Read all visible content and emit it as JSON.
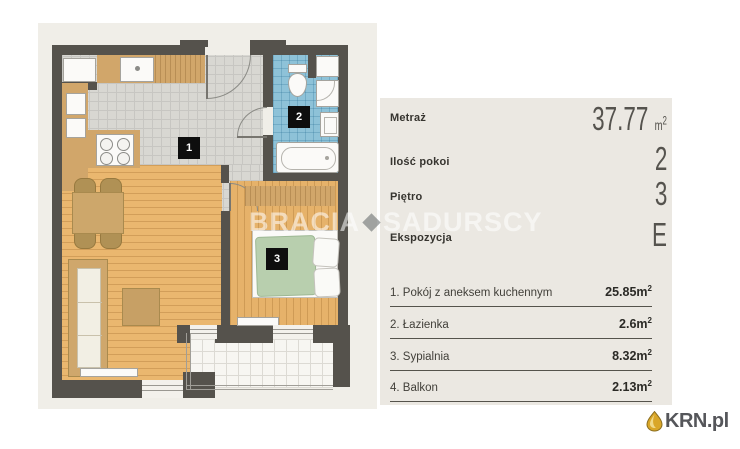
{
  "watermark": {
    "left": "BRACIA",
    "right": "SADURSCY"
  },
  "floor_plan": {
    "labels": {
      "living": "1",
      "bathroom": "2",
      "bedroom": "3"
    }
  },
  "details_panel": {
    "specs": [
      {
        "label": "Metraż",
        "value": "37.77",
        "unit_base": "m",
        "unit_sup": "2"
      },
      {
        "label": "Ilość pokoi",
        "value": "2"
      },
      {
        "label": "Piętro",
        "value": "3"
      },
      {
        "label": "Ekspozycja",
        "value": "E"
      }
    ],
    "rooms": [
      {
        "name": "1. Pokój z aneksem kuchennym",
        "area_base": "25.85m",
        "area_sup": "2"
      },
      {
        "name": "2. Łazienka",
        "area_base": "2.6m",
        "area_sup": "2"
      },
      {
        "name": "3. Sypialnia",
        "area_base": "8.32m",
        "area_sup": "2"
      },
      {
        "name": "4. Balkon",
        "area_base": "2.13m",
        "area_sup": "2"
      }
    ]
  },
  "branding": {
    "name": "KRN.pl"
  },
  "colors": {
    "wall": "#55524c",
    "wood": "#eab76f",
    "tile": "#d8d7d2",
    "bath_floor": "#8ec2d8",
    "plan_bg": "#f0eee8",
    "panel_bg": "#ebe8e2",
    "logo_gold": "#d9a628"
  }
}
